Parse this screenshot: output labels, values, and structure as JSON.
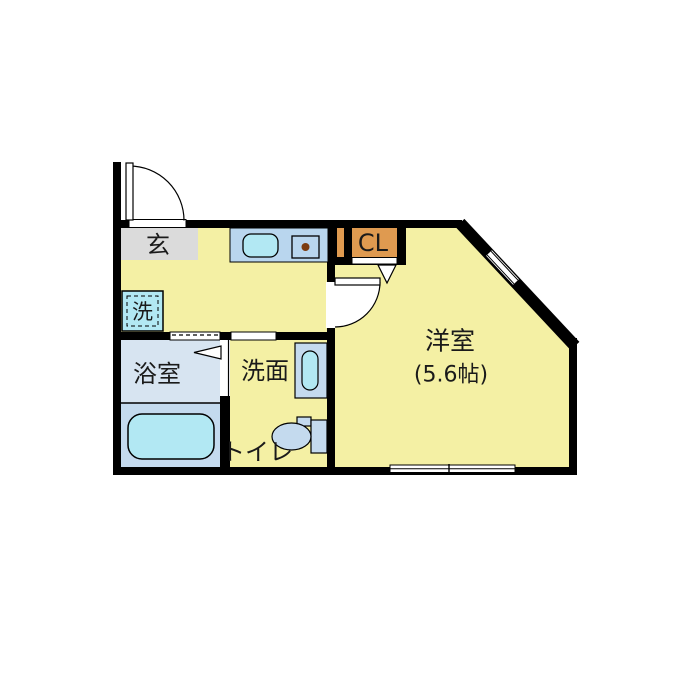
{
  "floorplan": {
    "labels": {
      "genkan": "玄",
      "closet": "CL",
      "western_room": "洋室",
      "western_room_size": "(5.6帖)",
      "bathroom": "浴室",
      "washroom": "洗面",
      "toilet": "トイレ",
      "washer": "洗"
    },
    "colors": {
      "background": "#ffffff",
      "wall": "#000000",
      "room_yellow": "#f4f0a4",
      "genkan_gray": "#dbdbdb",
      "counter_blue": "#b9d6ee",
      "fixture_cyan": "#b2e8f3",
      "fixture_blue": "#c4daee",
      "bath_floor": "#d7e4f1",
      "closet_orange": "#df9a50",
      "burner_brown": "#7c3c10"
    }
  }
}
